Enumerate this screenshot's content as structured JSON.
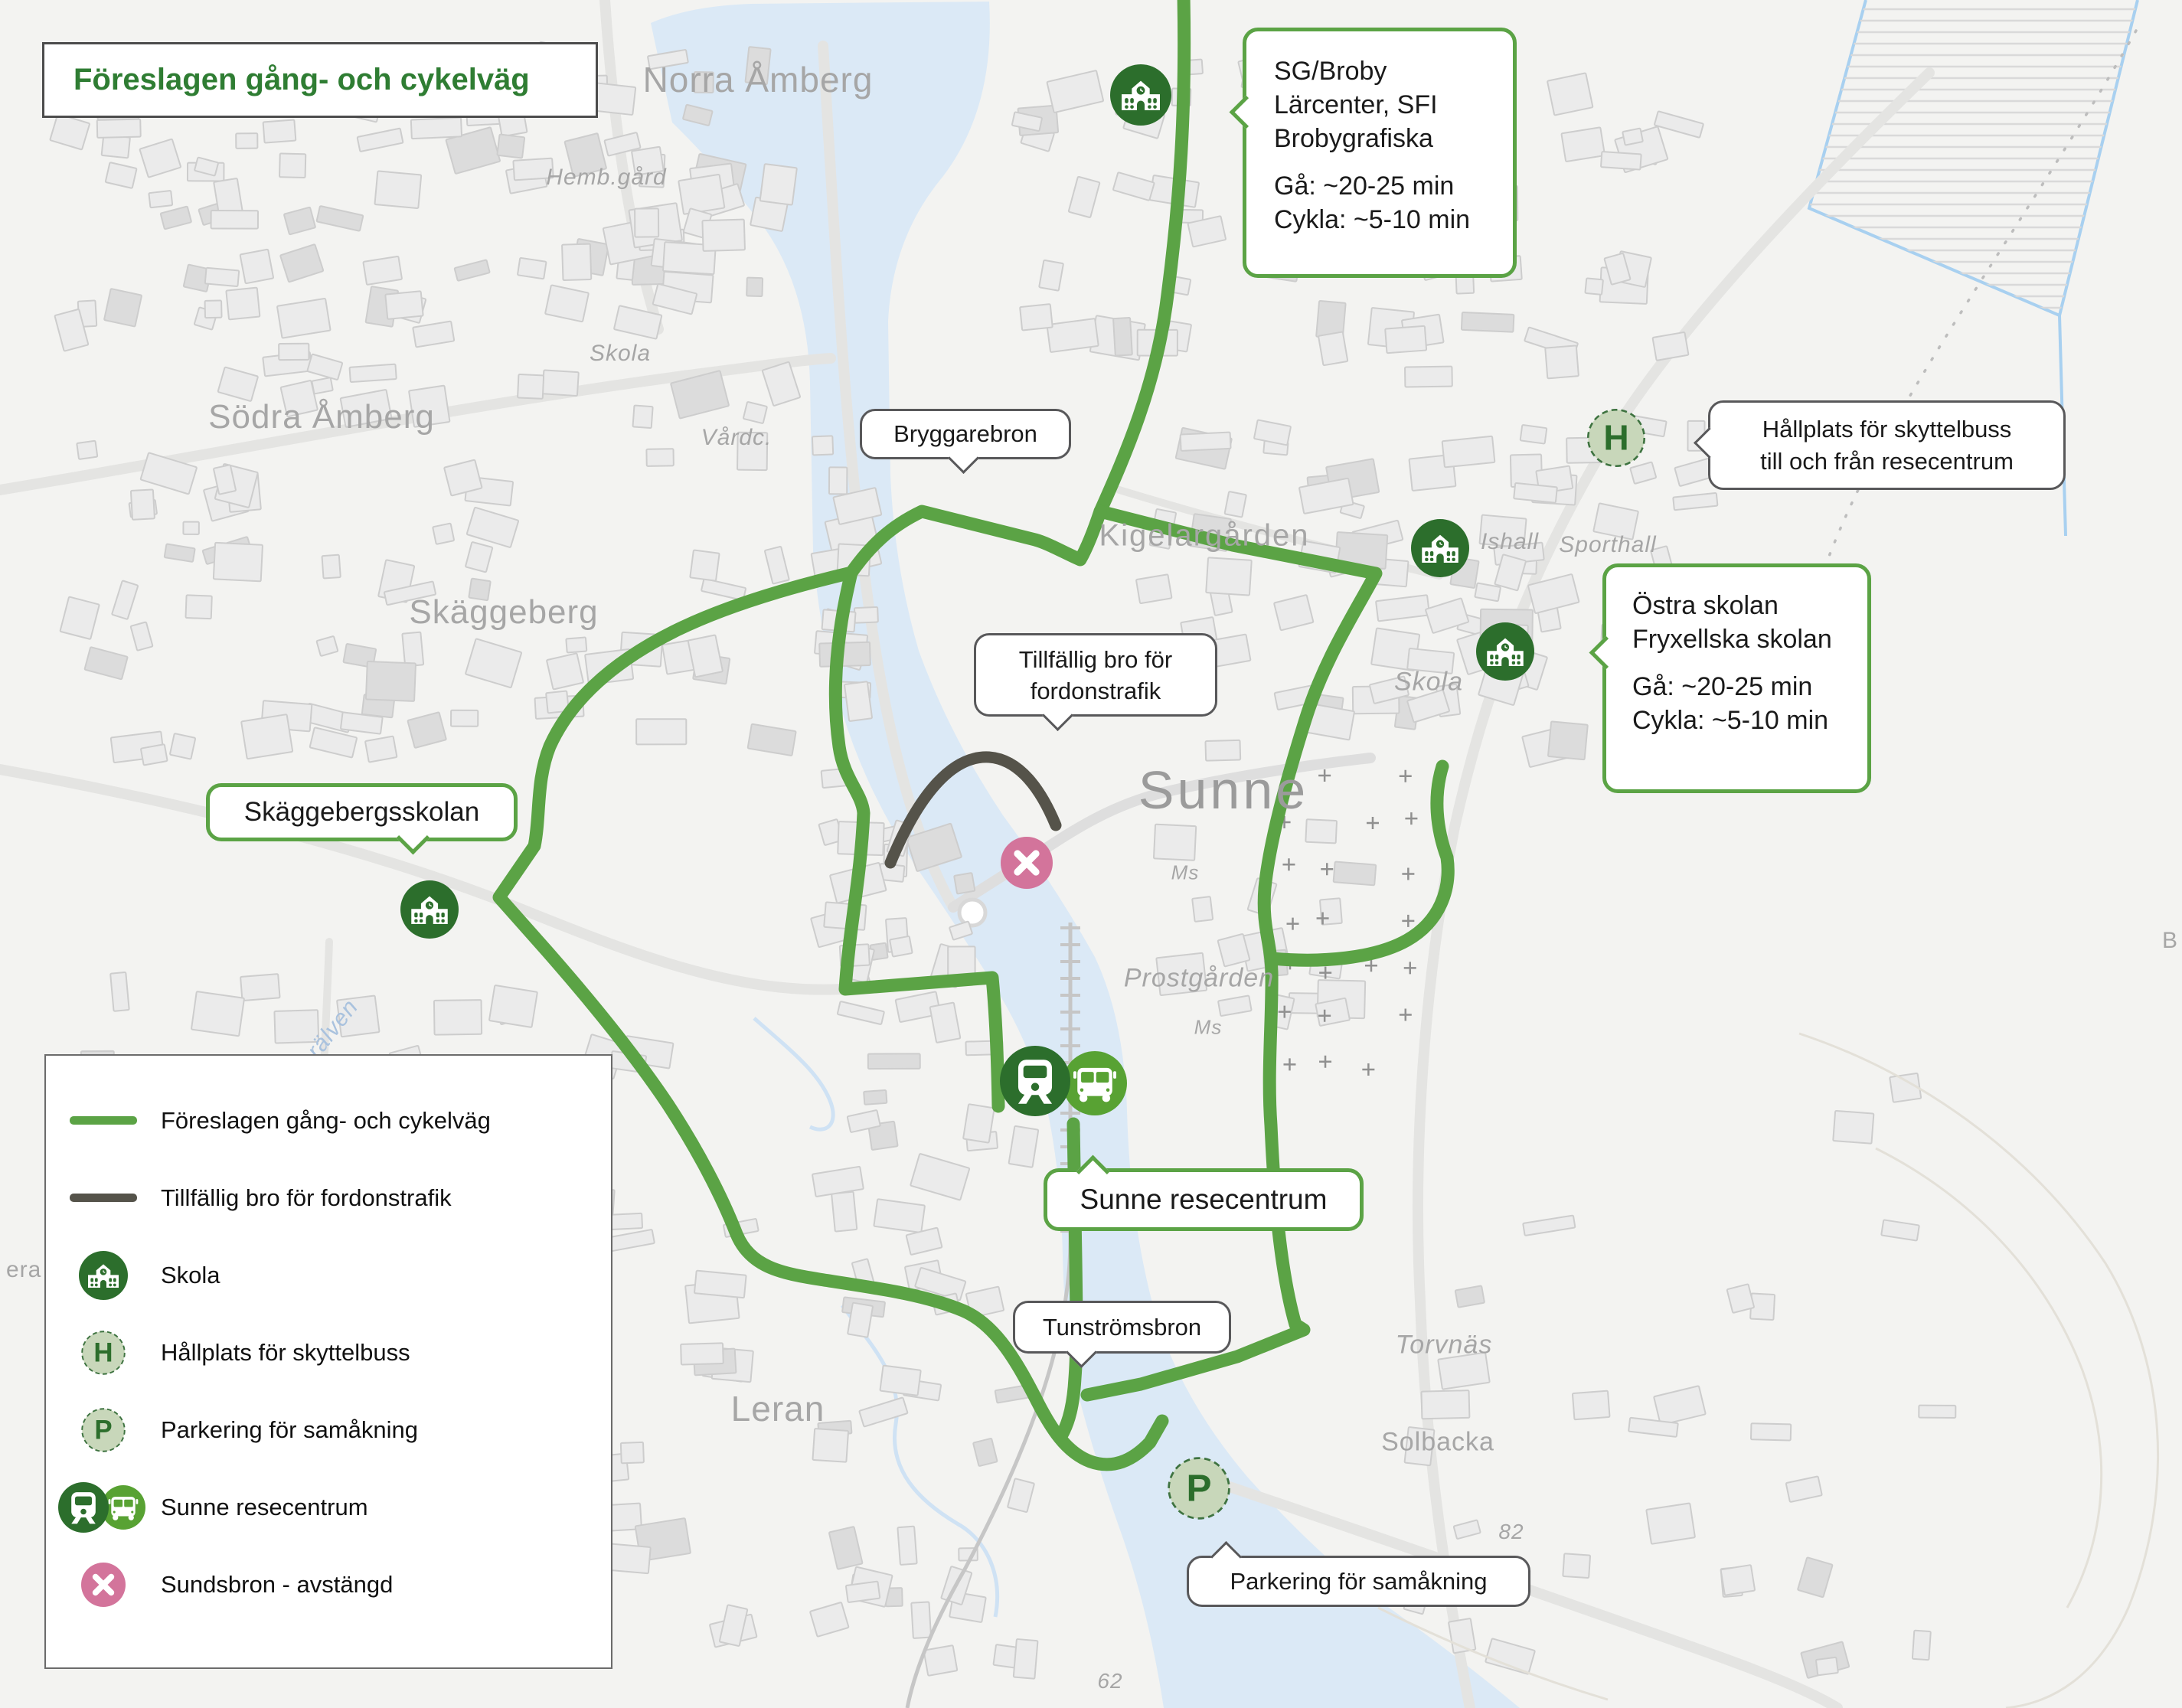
{
  "title": "Föreslagen gång- och cykelväg",
  "colors": {
    "route_green": "#5ba345",
    "dark_bridge": "#55534a",
    "school_green": "#2c6e2c",
    "bus_green": "#58a233",
    "stop_fill": "#c8d7ba",
    "stop_border": "#3e7340",
    "closed_pink": "#d3749b",
    "title_green": "#2f7d33",
    "water": "#dbe9f6",
    "label_gray": "#a6a6a6"
  },
  "icons": {
    "shuttle_letter": "H",
    "parking_letter": "P",
    "school": "school-icon",
    "train": "train-icon",
    "bus": "bus-icon",
    "closed": "closed-cross-icon"
  },
  "legend": {
    "items": [
      {
        "type": "line-green",
        "label": "Föreslagen gång- och cykelväg"
      },
      {
        "type": "line-dark",
        "label": "Tillfällig bro för fordonstrafik"
      },
      {
        "type": "school",
        "label": "Skola"
      },
      {
        "type": "h-stop",
        "label": "Hållplats för skyttelbuss"
      },
      {
        "type": "p-parking",
        "label": "Parkering för samåkning"
      },
      {
        "type": "resecentrum",
        "label": "Sunne resecentrum"
      },
      {
        "type": "closed",
        "label": "Sundsbron - avstängd"
      }
    ]
  },
  "callouts": {
    "sg_broby": {
      "line1": "SG/Broby",
      "line2": "Lärcenter, SFI",
      "line3": "Brobygrafiska",
      "walk": "Gå: ~20-25 min",
      "bike": "Cykla: ~5-10 min"
    },
    "bryggarebron": {
      "label": "Bryggarebron"
    },
    "hallplats": {
      "line1": "Hållplats för skyttelbuss",
      "line2": "till och från resecentrum"
    },
    "ostra": {
      "line1": "Östra skolan",
      "line2": "Fryxellska skolan",
      "walk": "Gå: ~20-25 min",
      "bike": "Cykla: ~5-10 min"
    },
    "tillfallig": {
      "line1": "Tillfällig bro för",
      "line2": "fordonstrafik"
    },
    "skaggebergsskolan": {
      "label": "Skäggebergsskolan"
    },
    "resecentrum": {
      "label": "Sunne resecentrum"
    },
    "tunstromsbron": {
      "label": "Tunströmsbron"
    },
    "parkering": {
      "label": "Parkering för samåkning"
    }
  },
  "map_labels": {
    "norra_amberg": "Norra Åmberg",
    "hembgard": "Hemb.gård",
    "skola_top": "Skola",
    "sodra_amberg": "Södra Åmberg",
    "vardc": "Vårdc.",
    "skaggeberg": "Skäggeberg",
    "kigelargarden": "Kigelargården",
    "ishall": "Ishall",
    "sporthall": "Sporthall",
    "skola_east": "Skola",
    "sunne": "Sunne",
    "ms_upper": "Ms",
    "prostgarden": "Prostgården",
    "ms_lower": "Ms",
    "leralven": "Lerälven",
    "leran": "Leran",
    "torvnas": "Torvnäs",
    "solbacka": "Solbacka",
    "n82": "82",
    "n62": "62",
    "era_partial": "era",
    "b_partial": "B"
  }
}
